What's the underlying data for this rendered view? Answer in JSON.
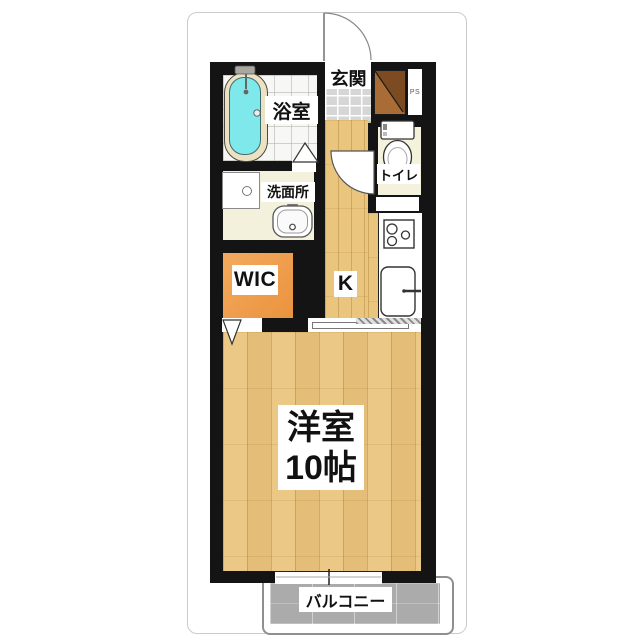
{
  "floorplan": {
    "rooms": {
      "entrance_label": "玄関",
      "bathroom_label": "浴室",
      "washroom_label": "洗面所",
      "toilet_label": "トイレ",
      "wic_label": "WIC",
      "kitchen_label": "K",
      "main_room_label_line1": "洋室",
      "main_room_label_line2": "10帖",
      "balcony_label": "バルコニー",
      "pipe_space_label": "PS"
    },
    "colors": {
      "wall": "#141414",
      "wood_floor": "#eac57e",
      "wic_floor": "#ef9d4d",
      "cream_floor": "#f3f0dc",
      "entrance_tile": "#d6d6d6",
      "balcony_concrete": "#ababab",
      "bathtub_water": "#7fe8ea",
      "cabinet_wood": "#a06532"
    }
  }
}
